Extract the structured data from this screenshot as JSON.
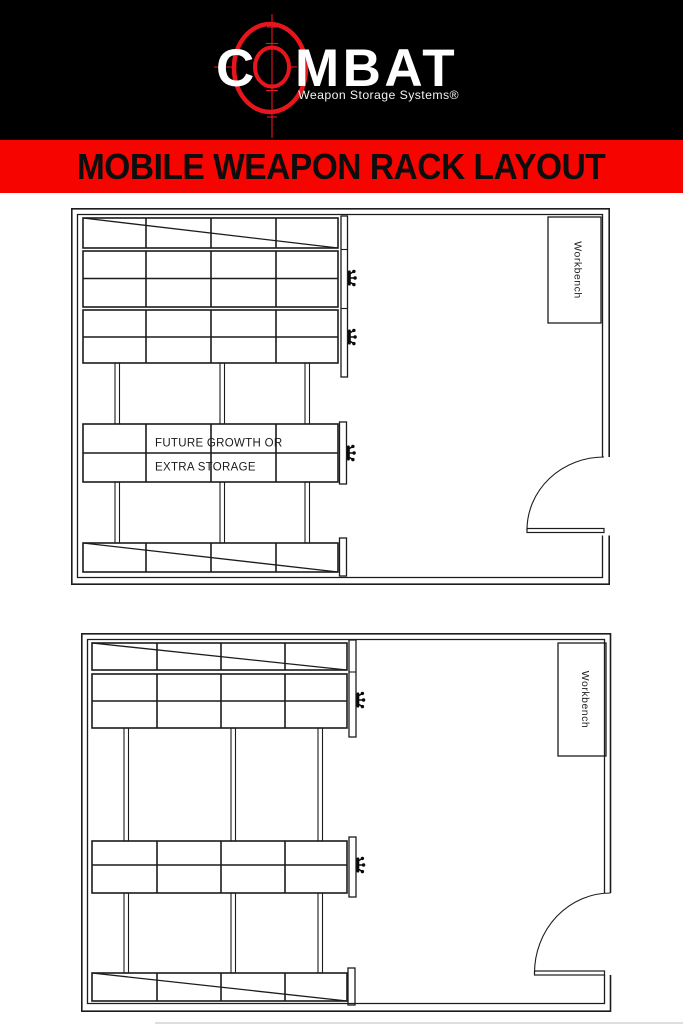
{
  "header": {
    "logo_part1": "C",
    "logo_part2": "MBAT",
    "logo_full_text": "COMBAT",
    "tagline": "Weapon Storage Systems®",
    "colors": {
      "background": "#000000",
      "brand_red": "#e8151c",
      "logo_text": "#ffffff"
    }
  },
  "banner": {
    "title": "MOBILE WEAPON RACK LAYOUT",
    "colors": {
      "background": "#f50400",
      "text": "#0d0d0d"
    }
  },
  "diagram_top": {
    "workbench_label": "Workbench",
    "future_growth_line1": "FUTURE GROWTH OR",
    "future_growth_line2": "EXTRA STORAGE"
  },
  "diagram_bottom": {
    "workbench_label": "Workbench"
  },
  "icons": {
    "crank_handle": "crank-handle-icon (3-spoke mobile rack crank, black glyph)",
    "door_swing": "door-swing-arc (quarter-circle door swing symbol)",
    "crosshair": "crosshair-target-icon (red scope reticle around logo O)"
  },
  "line_color": "#1c1c1c"
}
